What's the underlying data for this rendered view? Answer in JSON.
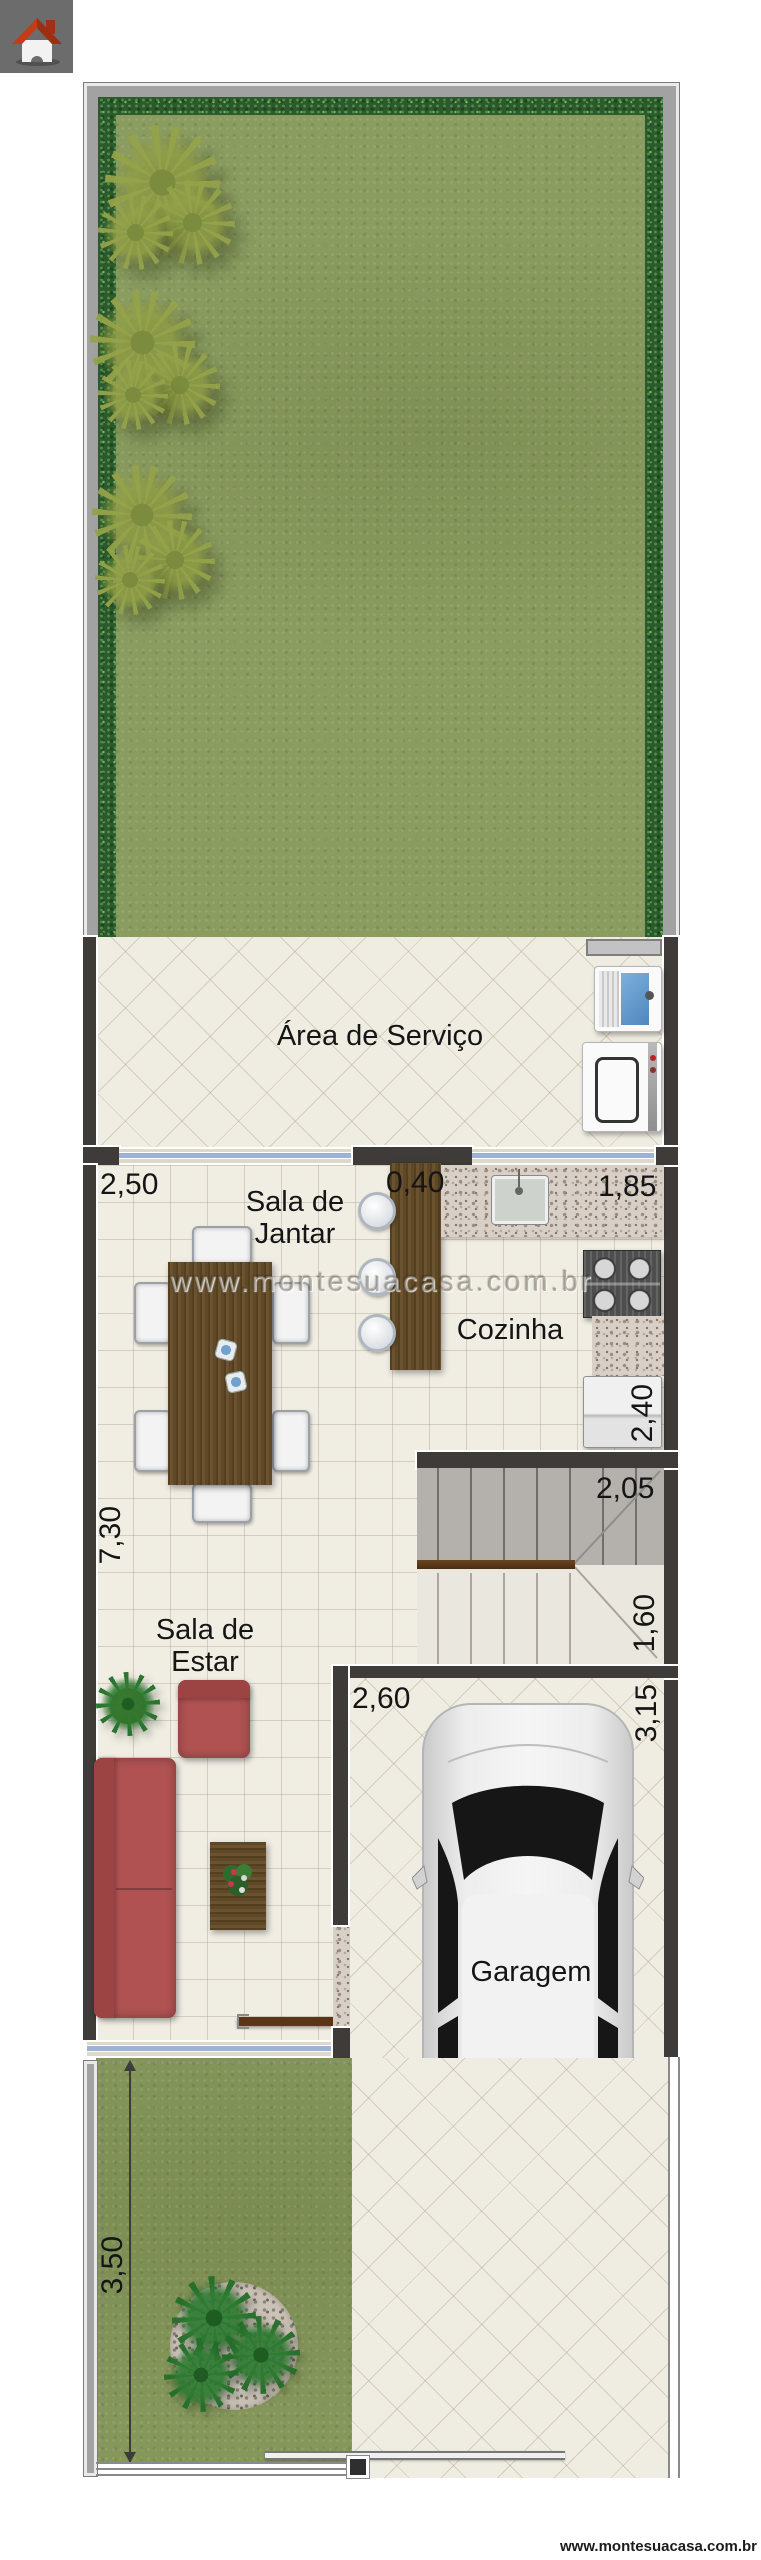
{
  "site": {
    "watermark": "www.montesuacasa.com.br",
    "footer_url": "www.montesuacasa.com.br"
  },
  "icons": {
    "logo": "house-icon"
  },
  "rooms": {
    "service_area": "Área de Serviço",
    "dining": "Sala de\nJantar",
    "kitchen": "Cozinha",
    "living": "Sala de\nEstar",
    "garage": "Garagem"
  },
  "dimensions": {
    "dining_width": "2,50",
    "bar_width": "0,40",
    "kitchen_width": "1,85",
    "living_length": "7,30",
    "kitchen_depth": "2,40",
    "stairs_width": "2,05",
    "stairs_depth": "1,60",
    "garage_width": "2,60",
    "garage_length": "3,15",
    "front_yard_length": "3,50"
  },
  "colors": {
    "wall_dark": "#3e3b38",
    "outer_wall_gray": "#a2a2a2",
    "lawn_green": "#8b9c60",
    "hedge_green": "#2d5a2c",
    "glass_blue": "#9db2d4",
    "wood_brown": "#5e4827",
    "sofa_red": "#b05252"
  }
}
